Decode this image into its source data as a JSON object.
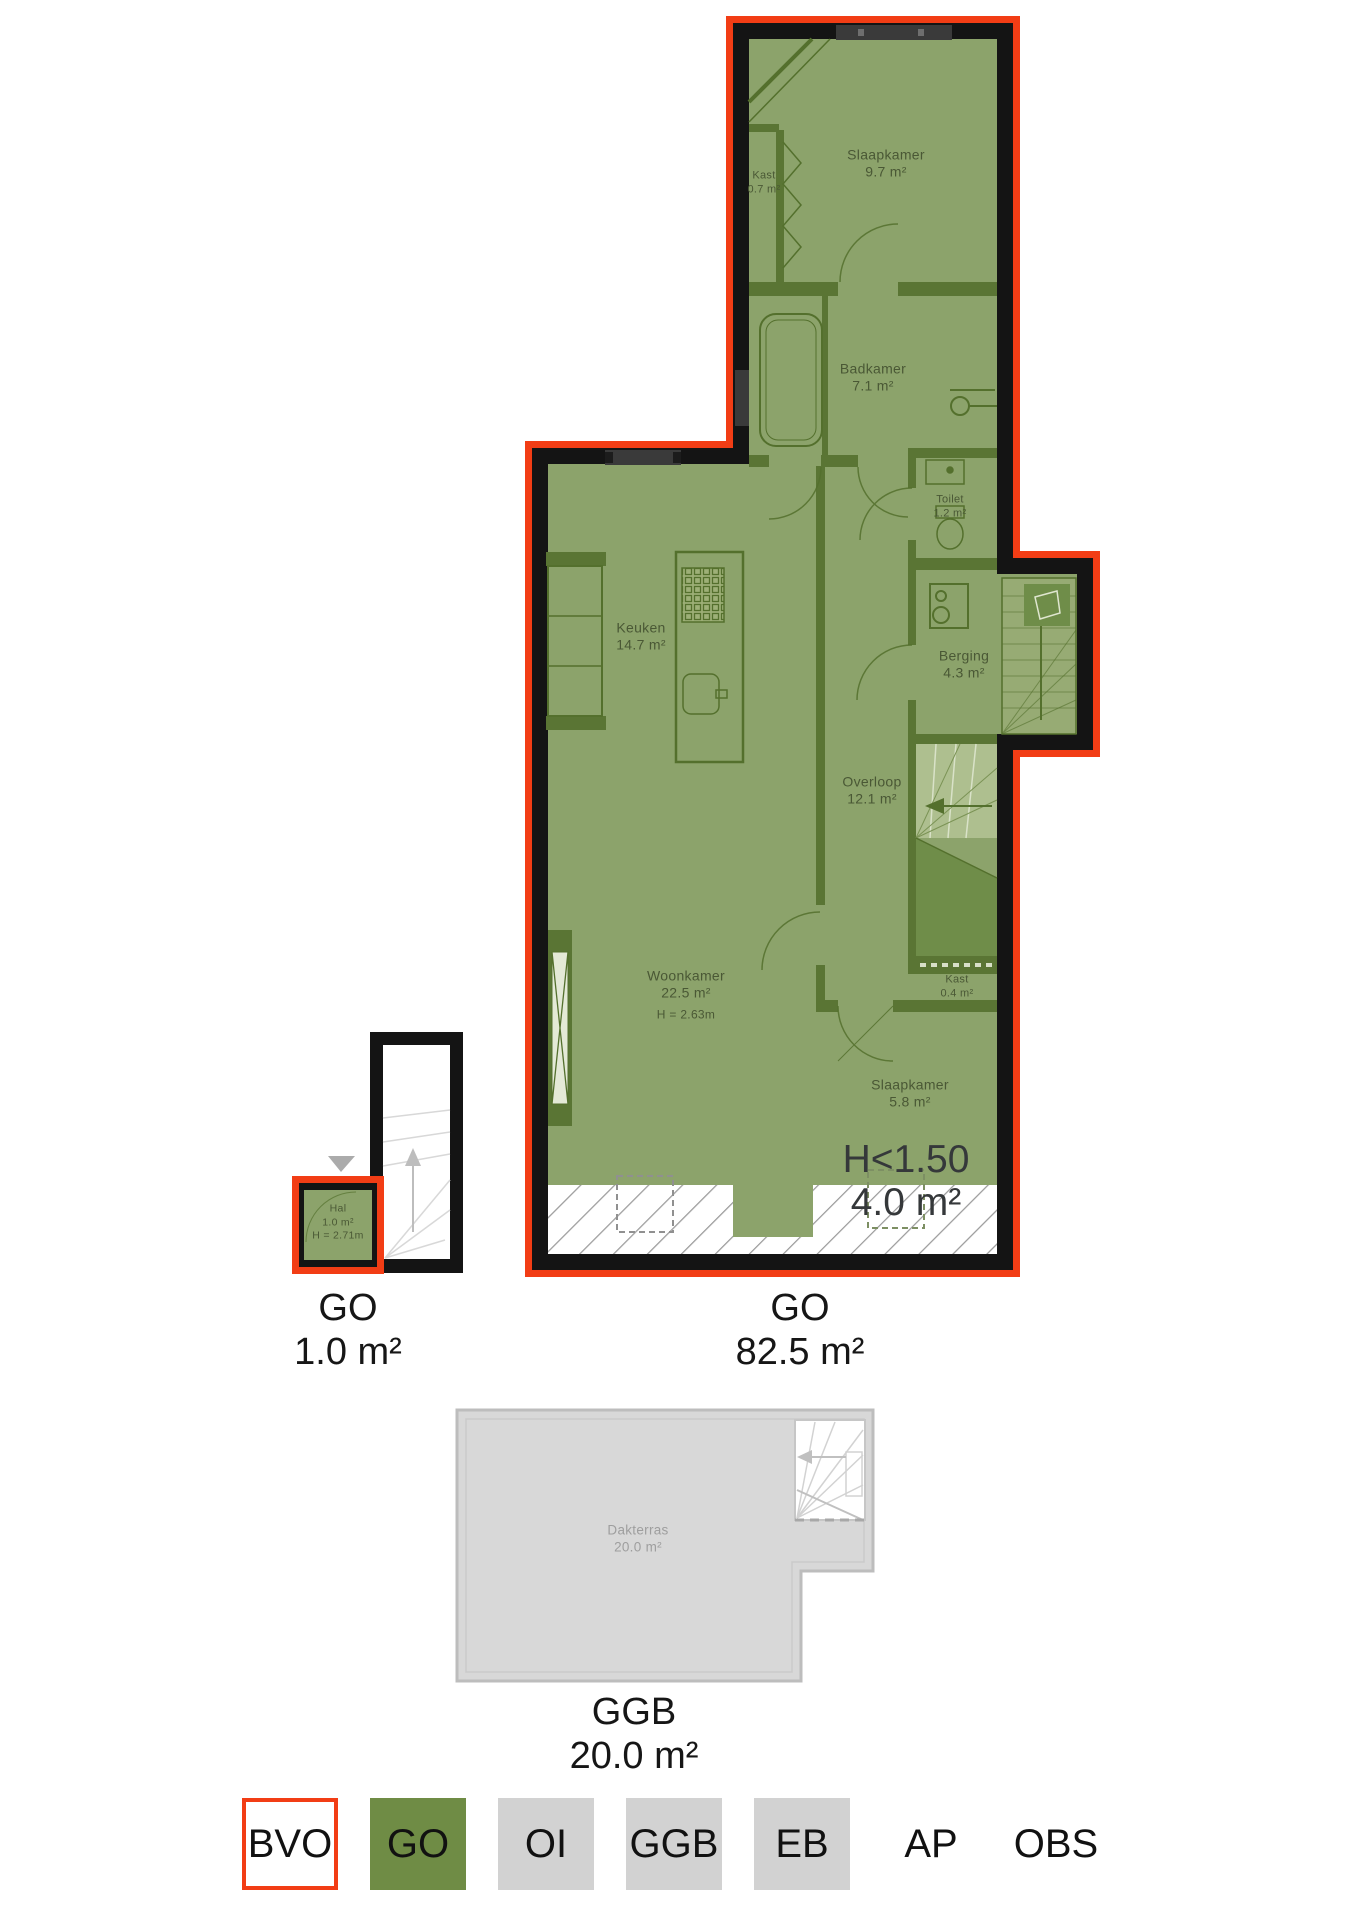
{
  "plan": {
    "rooms": {
      "slaapkamer_boven": {
        "name": "Slaapkamer",
        "area": "9.7 m²"
      },
      "kast_boven": {
        "name": "Kast",
        "area": "0.7 m²"
      },
      "badkamer": {
        "name": "Badkamer",
        "area": "7.1 m²"
      },
      "toilet": {
        "name": "Toilet",
        "area": "1.2 m²"
      },
      "keuken": {
        "name": "Keuken",
        "area": "14.7 m²"
      },
      "berging": {
        "name": "Berging",
        "area": "4.3 m²"
      },
      "overloop": {
        "name": "Overloop",
        "area": "12.1 m²"
      },
      "woonkamer": {
        "name": "Woonkamer",
        "area": "22.5 m²",
        "height": "H = 2.63m"
      },
      "kast_onder": {
        "name": "Kast",
        "area": "0.4 m²"
      },
      "slaapkamer_onder": {
        "name": "Slaapkamer",
        "area": "5.8 m²"
      },
      "hal": {
        "name": "Hal",
        "area": "1.0 m²",
        "height": "H = 2.71m"
      },
      "dakterras": {
        "name": "Dakterras",
        "area": "20.0 m²"
      }
    },
    "annotations": {
      "low_headroom": {
        "label": "H<1.50",
        "area": "4.0 m²"
      }
    },
    "unit_labels": {
      "hal_unit": {
        "code": "GO",
        "area": "1.0 m²"
      },
      "main_unit": {
        "code": "GO",
        "area": "82.5 m²"
      },
      "terrace_unit": {
        "code": "GGB",
        "area": "20.0 m²"
      }
    }
  },
  "legend": {
    "items": [
      {
        "label": "BVO"
      },
      {
        "label": "GO"
      },
      {
        "label": "OI"
      },
      {
        "label": "GGB"
      },
      {
        "label": "EB"
      },
      {
        "label": "AP"
      },
      {
        "label": "OBS"
      }
    ]
  },
  "colors": {
    "surface_green": "#8CA36B",
    "legend_green": "#6F8C45",
    "outline_red": "#F23D15",
    "wall_black": "#141414",
    "partition_green": "#5A7534",
    "terrace_grey": "#D8D8D8",
    "legend_grey": "#D2D2D2"
  }
}
